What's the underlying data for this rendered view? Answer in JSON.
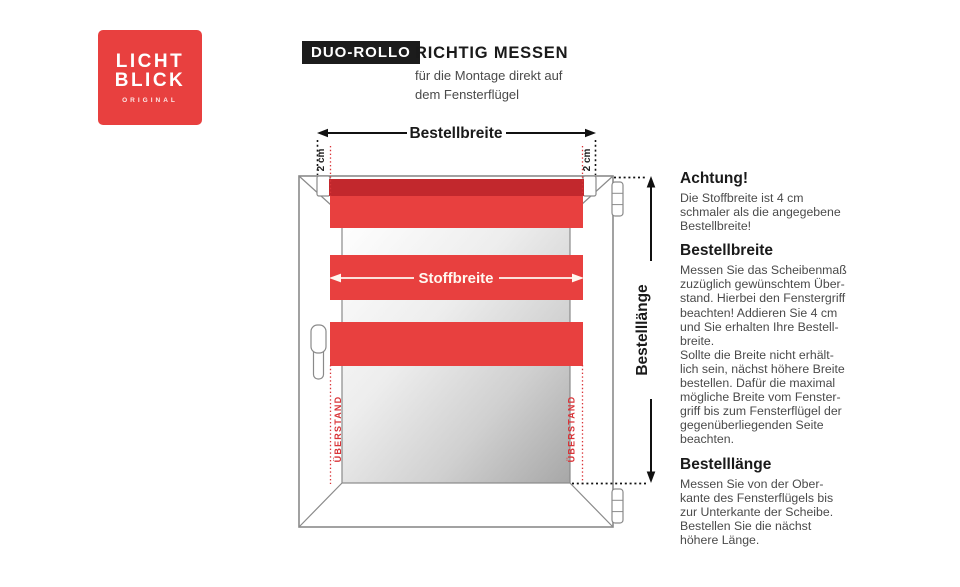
{
  "logo": {
    "line1": "LICHT",
    "line2": "BLICK",
    "subline": "ORIGINAL",
    "bg_color": "#e8403f"
  },
  "header": {
    "badge": "DUO-ROLLO",
    "title": "RICHTIG MESSEN",
    "subtitle": "für die Montage direkt auf\ndem Fensterflügel"
  },
  "diagram": {
    "bestellbreite_label": "Bestellbreite",
    "stoffbreite_label": "Stoffbreite",
    "bestelllaenge_label": "Bestelllänge",
    "offset_left_label": "2 cm",
    "offset_right_label": "2 cm",
    "ueberstand_left_label": "ÜBERSTAND",
    "ueberstand_right_label": "ÜBERSTAND",
    "colors": {
      "fabric_red": "#e8403f",
      "roller_red": "#c2282d",
      "marker_red": "#d93438",
      "frame_gray": "#8a8a8a"
    }
  },
  "info": {
    "sections": [
      {
        "heading": "Achtung!",
        "body": "Die Stoffbreite ist 4 cm\nschmaler als die angegebene\nBestellbreite!"
      },
      {
        "heading": "Bestellbreite",
        "body": "Messen Sie das Scheibenmaß\nzuzüglich gewünschtem Über-\nstand. Hierbei den Fenstergriff\nbeachten! Addieren Sie 4 cm\nund Sie erhalten Ihre Bestell-\nbreite.\nSollte die Breite nicht erhält-\nlich sein, nächst höhere Breite\nbestellen. Dafür die maximal\nmögliche Breite vom Fenster-\ngriff bis zum Fensterflügel der\ngegenüberliegenden Seite\nbeachten."
      },
      {
        "heading": "Bestelllänge",
        "body": "Messen Sie von der Ober-\nkante des Fensterflügels bis\nzur Unterkante der Scheibe.\nBestellen Sie die nächst\nhöhere Länge."
      }
    ]
  }
}
